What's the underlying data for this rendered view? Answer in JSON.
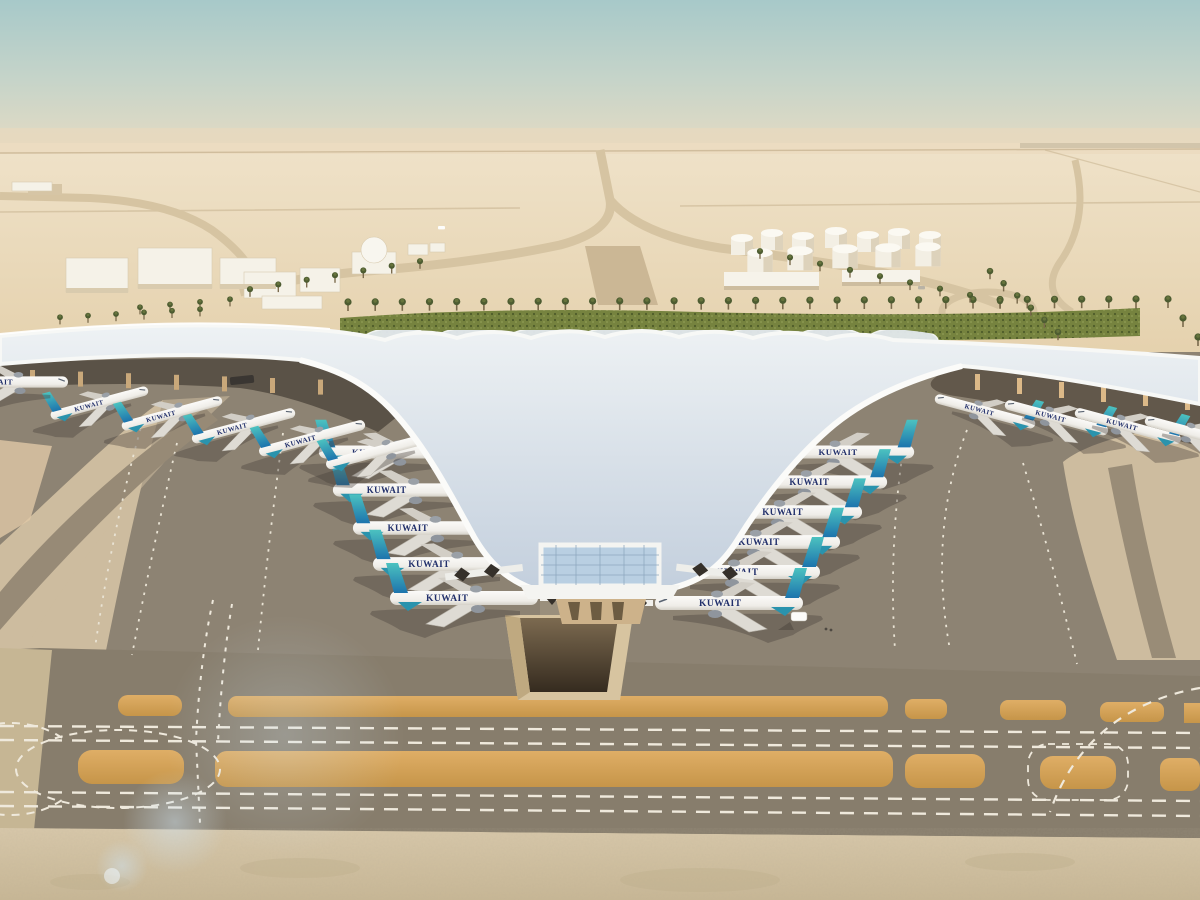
{
  "scene": {
    "airline_label": "KUWAIT",
    "colors": {
      "sky_top": "#a9cbca",
      "sky_horizon": "#e8dcc2",
      "desert_sand": "#e9d8b8",
      "apron_asphalt": "#8d8373",
      "concrete_light": "#cdbc9f",
      "amber_shoulder": "#d3a55c",
      "roof_light": "#eef1f4",
      "roof_panel_blue": "#8ba0ba",
      "tail_teal": "#45bcbc",
      "tail_blue": "#1d74ad",
      "hedge_green": "#76833f",
      "marking_white": "#efe9dc"
    },
    "counts": {
      "left_column_planes": 5,
      "right_column_planes": 6,
      "left_canopy_planes": 5,
      "right_canopy_planes": 4
    }
  }
}
